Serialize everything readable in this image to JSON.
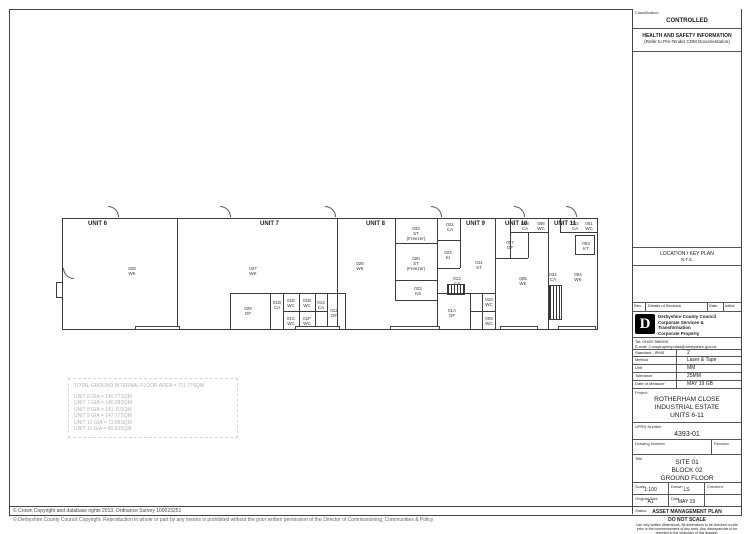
{
  "sheet": {
    "classification_label": "Classification",
    "classification_value": "CONTROLLED",
    "hs_title": "HEALTH AND SAFETY INFORMATION",
    "hs_subtitle": "(Refer to Pre-Tender CDM Documentation)",
    "location_title": "LOCATION / KEY PLAN",
    "location_scale": "N.T.S.",
    "revision_headers": [
      "Rev.",
      "Details of Revision",
      "Date",
      "Initial"
    ],
    "org": {
      "line1": "Derbyshire County Council",
      "line2": "Corporate Services &",
      "line3": "Transformation",
      "line4": "Corporate Property",
      "tel": "Tel: 01629 580000",
      "email": "E-mail: Consproperty.data@derbyshire.gov.uk"
    },
    "survey": [
      {
        "label": "Standard : IPMS",
        "value": "2"
      },
      {
        "label": "Method",
        "value": "Laser & Tape"
      },
      {
        "label": "Unit",
        "value": "MM"
      },
      {
        "label": "Tolerance",
        "value": "25MM"
      },
      {
        "label": "Date of Measure",
        "value": "MAY 19 GB"
      }
    ],
    "project_label": "Project",
    "project_lines": [
      "ROTHERHAM CLOSE",
      "INDUSTRIAL ESTATE",
      "UNITS 6-11"
    ],
    "uprn_label": "UPRN Number",
    "uprn_value": "4393-01",
    "drawing_number_label": "Drawing Number",
    "revision_label": "Revision",
    "title_label": "Title",
    "title_lines": [
      "SITE 01",
      "BLOCK 02",
      "GROUND FLOOR"
    ],
    "scale_label": "Scale",
    "scale_value": "1:100",
    "drawn_label": "Drawn",
    "drawn_value": "LS",
    "checked_label": "Checked",
    "checked_value": "",
    "size_label": "Original Size",
    "size_value": "A1",
    "date_label": "Date",
    "date_value": "MAY 19",
    "status_label": "Status",
    "status_value": "ASSET MANAGEMENT PLAN",
    "do_not_scale": "DO NOT SCALE",
    "disclaimer": "Use only written dimensions. All dimensions to be checked on site prior to the commencement of any work. Any discrepancies to be reported to the originator of this drawing."
  },
  "plan": {
    "unit_labels": [
      {
        "t": "UNIT 6",
        "x": 88,
        "y": 221
      },
      {
        "t": "UNIT 7",
        "x": 260,
        "y": 221
      },
      {
        "t": "UNIT 8",
        "x": 366,
        "y": 221
      },
      {
        "t": "UNIT 9",
        "x": 466,
        "y": 221
      },
      {
        "t": "UNIT 10",
        "x": 505,
        "y": 221
      },
      {
        "t": "UNIT 11",
        "x": 554,
        "y": 221
      }
    ],
    "rooms": [
      {
        "num": "028",
        "type": "WK",
        "x": 132,
        "y": 266
      },
      {
        "num": "027",
        "type": "WK",
        "x": 253,
        "y": 266
      },
      {
        "num": "026",
        "type": "WK",
        "x": 360,
        "y": 261
      },
      {
        "num": "033",
        "type": "ST",
        "extra": "(Freezer)",
        "x": 416,
        "y": 226
      },
      {
        "num": "020",
        "type": "ST",
        "extra": "(Freezer)",
        "x": 416,
        "y": 256
      },
      {
        "num": "023",
        "type": "KS",
        "x": 418,
        "y": 286
      },
      {
        "num": "021",
        "type": "CA",
        "x": 450,
        "y": 222
      },
      {
        "num": "022",
        "type": "KI",
        "x": 448,
        "y": 250
      },
      {
        "num": "011",
        "type": "ST",
        "x": 479,
        "y": 260
      },
      {
        "num": "013",
        "type": "CA",
        "x": 457,
        "y": 276
      },
      {
        "num": "01A",
        "type": "OF",
        "x": 452,
        "y": 308
      },
      {
        "num": "010",
        "type": "WC",
        "x": 489,
        "y": 297
      },
      {
        "num": "009",
        "type": "WC",
        "x": 489,
        "y": 316
      },
      {
        "num": "008",
        "type": "CA",
        "x": 525,
        "y": 221
      },
      {
        "num": "006",
        "type": "WC",
        "x": 541,
        "y": 221
      },
      {
        "num": "007",
        "type": "OF",
        "x": 510,
        "y": 240
      },
      {
        "num": "005",
        "type": "WK",
        "x": 523,
        "y": 276
      },
      {
        "num": "002",
        "type": "CA",
        "x": 575,
        "y": 221
      },
      {
        "num": "001",
        "type": "WC",
        "x": 589,
        "y": 221
      },
      {
        "num": "003",
        "type": "KT",
        "x": 586,
        "y": 241
      },
      {
        "num": "004",
        "type": "WK",
        "x": 578,
        "y": 272
      },
      {
        "num": "034",
        "type": "CA",
        "x": 553,
        "y": 272
      },
      {
        "num": "029",
        "type": "OF",
        "x": 248,
        "y": 306
      },
      {
        "num": "01D",
        "type": "CA",
        "x": 277,
        "y": 300
      },
      {
        "num": "01E",
        "type": "WC",
        "x": 291,
        "y": 298
      },
      {
        "num": "01B",
        "type": "WC",
        "x": 307,
        "y": 298
      },
      {
        "num": "01C",
        "type": "WC",
        "x": 291,
        "y": 316
      },
      {
        "num": "01F",
        "type": "WC",
        "x": 307,
        "y": 316
      },
      {
        "num": "014",
        "type": "CA",
        "x": 321,
        "y": 300
      },
      {
        "num": "012",
        "type": "OF",
        "x": 334,
        "y": 308
      }
    ],
    "areas": {
      "title": "TOTAL GROUND INTERNAL FLOOR AREA = 711.77SQM",
      "lines": [
        "UNIT 6 GIA = 140.77SQM",
        "UNIT 7 GIA = 140.99SQM",
        "UNIT 8 GIA = 141.11SQM",
        "UNIT 9 GIA = 147.77SQM",
        "UNIT 10 GIA = 73.85SQM",
        "UNIT 11 GIA = 66.93SQM"
      ]
    }
  },
  "footer": {
    "line1": "© Crown Copyright and database rights 2013. Ordnance Survey 100023251",
    "line2": "© Derbyshire County Council Copyright.  Reproduction in whole or part by any means is prohibited without the prior written permission of the Director of Commissioning, Communities & Policy"
  }
}
